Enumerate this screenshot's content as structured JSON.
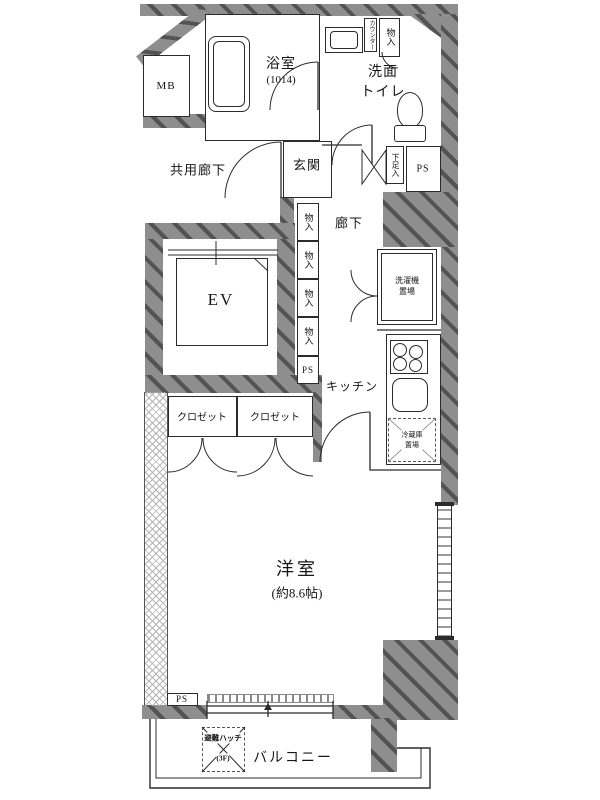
{
  "colors": {
    "wall": "#8e8e8e",
    "wall_stripe": "#4f4f4f",
    "line": "#2b2b2b",
    "text": "#161616"
  },
  "labels": {
    "mb": "MB",
    "bath": "浴室",
    "bath_size": "(1014)",
    "counter": "カウンター",
    "storage_top": "物入",
    "washroom_l1": "洗面",
    "washroom_l2": "トイレ",
    "common_corridor": "共用廊下",
    "entrance": "玄関",
    "shoe_cabinet": "下足入",
    "ps_top": "PS",
    "corridor": "廊下",
    "ev": "EV",
    "storage_column": [
      "物入",
      "物入",
      "物入",
      "物入"
    ],
    "ps_mid": "PS",
    "washer_l1": "洗濯機",
    "washer_l2": "置場",
    "kitchen": "キッチン",
    "fridge_l1": "冷蔵庫",
    "fridge_l2": "置場",
    "closet_left": "クロゼット",
    "closet_right": "クロゼット",
    "room": "洋室",
    "room_size": "(約8.6帖)",
    "ps_bottom": "PS",
    "hatch_l1": "避難ハッチ",
    "hatch_l2": "(3F)",
    "balcony": "バルコニー"
  }
}
